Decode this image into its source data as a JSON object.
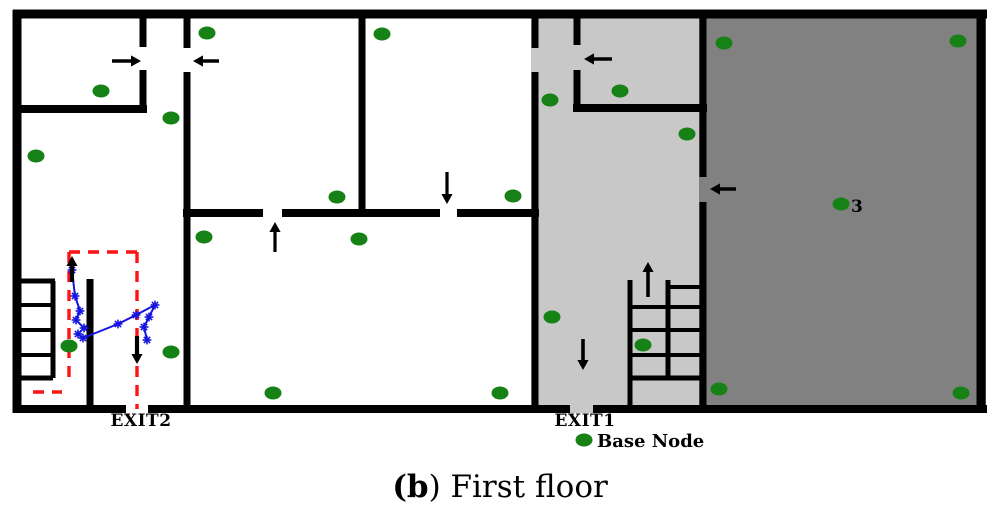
{
  "figure": {
    "caption_prefix": "(",
    "caption_bold": "b",
    "caption_rest": ") First floor"
  },
  "legend": {
    "label": "Base Node"
  },
  "labels": {
    "exit1": "EXIT1",
    "exit2": "EXIT2",
    "node_number": "3"
  },
  "colors": {
    "background": "#ffffff",
    "wall": "#000000",
    "light_room": "#c8c8c8",
    "dark_room": "#818181",
    "node": "#168216",
    "escape_route": "#ff1212",
    "trajectory": "#1515e0",
    "arrow": "#000000"
  },
  "floorplan": {
    "regions": [
      {
        "name": "light-gray-room",
        "x": 531,
        "y": 10,
        "w": 176,
        "h": 403
      },
      {
        "name": "dark-gray-room",
        "x": 699,
        "y": 10,
        "w": 287,
        "h": 403
      }
    ],
    "walls": [
      [
        13,
        14,
        987,
        14,
        9
      ],
      [
        17,
        10,
        17,
        413,
        9
      ],
      [
        981,
        10,
        981,
        413,
        9
      ],
      [
        13,
        409,
        126,
        409,
        8
      ],
      [
        148,
        409,
        570,
        409,
        8
      ],
      [
        593,
        409,
        987,
        409,
        8
      ],
      [
        13,
        109,
        147,
        109,
        8
      ],
      [
        143,
        10,
        143,
        47,
        7
      ],
      [
        143,
        70,
        143,
        113,
        7
      ],
      [
        187,
        10,
        187,
        48,
        7
      ],
      [
        187,
        72,
        187,
        413,
        7
      ],
      [
        362,
        10,
        362,
        217,
        7
      ],
      [
        183,
        213,
        263,
        213,
        8
      ],
      [
        282,
        213,
        440,
        213,
        8
      ],
      [
        457,
        213,
        539,
        213,
        8
      ],
      [
        535,
        10,
        535,
        48,
        7
      ],
      [
        535,
        72,
        535,
        413,
        7
      ],
      [
        577,
        10,
        577,
        45,
        7
      ],
      [
        577,
        70,
        577,
        112,
        7
      ],
      [
        573,
        108,
        707,
        108,
        8
      ],
      [
        703,
        10,
        703,
        177,
        7
      ],
      [
        703,
        202,
        703,
        413,
        7
      ],
      [
        90,
        279,
        90,
        413,
        7
      ]
    ],
    "stairs": [
      [
        17,
        281,
        55,
        281,
        5
      ],
      [
        17,
        305,
        53,
        305,
        4
      ],
      [
        17,
        330,
        53,
        330,
        4
      ],
      [
        17,
        355,
        53,
        355,
        4
      ],
      [
        17,
        378,
        53,
        378,
        5
      ],
      [
        53,
        281,
        53,
        378,
        5
      ],
      [
        630,
        280,
        630,
        409,
        5
      ],
      [
        668,
        280,
        668,
        378,
        5
      ],
      [
        668,
        287,
        703,
        287,
        4
      ],
      [
        630,
        307,
        703,
        307,
        4
      ],
      [
        630,
        330,
        703,
        330,
        4
      ],
      [
        630,
        355,
        703,
        355,
        4
      ],
      [
        630,
        378,
        703,
        378,
        5
      ]
    ],
    "escape_route_dashed": [
      [
        69,
        252,
        69,
        385
      ],
      [
        69,
        252,
        137,
        252
      ],
      [
        137,
        252,
        137,
        409
      ],
      [
        33,
        392,
        62,
        392
      ]
    ],
    "trajectory_points": [
      [
        72,
        270
      ],
      [
        75,
        296
      ],
      [
        80,
        311
      ],
      [
        76,
        320
      ],
      [
        84,
        328
      ],
      [
        78,
        334
      ],
      [
        83,
        338
      ],
      [
        118,
        324
      ],
      [
        136,
        315
      ],
      [
        155,
        305
      ],
      [
        149,
        317
      ],
      [
        144,
        327
      ],
      [
        147,
        340
      ]
    ],
    "arrows": [
      [
        112,
        61,
        141,
        61,
        3.4
      ],
      [
        219,
        61,
        193,
        61,
        3.4
      ],
      [
        612,
        59,
        584,
        59,
        3.4
      ],
      [
        736,
        189,
        710,
        189,
        3.4
      ],
      [
        447,
        172,
        447,
        204,
        3.2
      ],
      [
        275,
        252,
        275,
        222,
        3.2
      ],
      [
        72,
        282,
        72,
        256,
        4.2
      ],
      [
        137,
        336,
        137,
        364,
        4.2
      ],
      [
        648,
        297,
        648,
        262,
        3.6
      ],
      [
        583,
        339,
        583,
        370,
        3.6
      ]
    ],
    "nodes": [
      [
        101,
        91
      ],
      [
        207,
        33
      ],
      [
        171,
        118
      ],
      [
        36,
        156
      ],
      [
        382,
        34
      ],
      [
        337,
        197
      ],
      [
        513,
        196
      ],
      [
        204,
        237
      ],
      [
        359,
        239
      ],
      [
        273,
        393
      ],
      [
        500,
        393
      ],
      [
        69,
        346
      ],
      [
        171,
        352
      ],
      [
        550,
        100
      ],
      [
        620,
        91
      ],
      [
        552,
        317
      ],
      [
        643,
        345
      ],
      [
        724,
        43
      ],
      [
        958,
        41
      ],
      [
        687,
        134
      ],
      [
        841,
        204
      ],
      [
        719,
        389
      ],
      [
        961,
        393
      ]
    ],
    "numbered_node": [
      841,
      204
    ],
    "legend_dot": [
      584,
      440
    ]
  }
}
